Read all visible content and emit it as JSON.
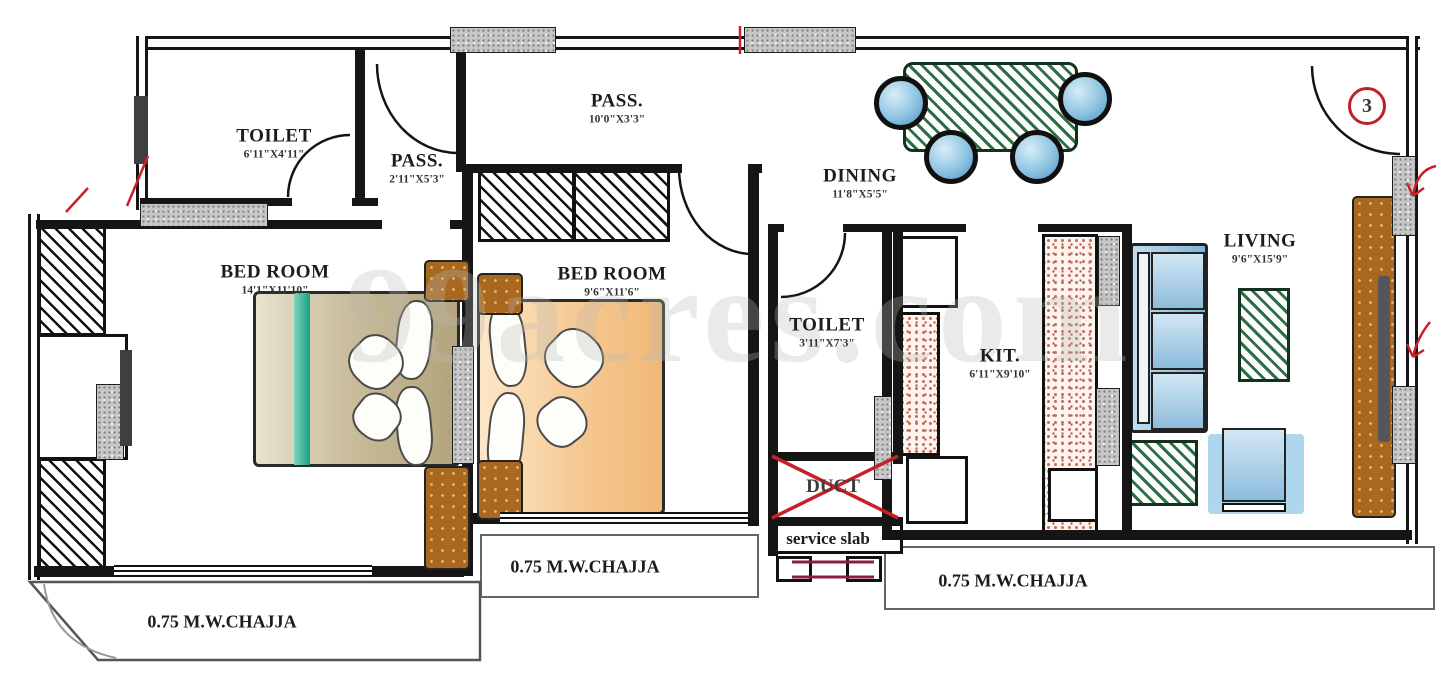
{
  "watermark": {
    "text": "99acres.com"
  },
  "unit": {
    "number": "3"
  },
  "rooms": [
    {
      "name": "TOILET",
      "dims": "6'11\"X4'11\""
    },
    {
      "name": "PASS.",
      "dims": "2'11\"X5'3\""
    },
    {
      "name": "PASS.",
      "dims": "10'0\"X3'3\""
    },
    {
      "name": "BED ROOM",
      "dims": "14'1\"X11'10\""
    },
    {
      "name": "BED ROOM",
      "dims": "9'6\"X11'6\""
    },
    {
      "name": "DINING",
      "dims": "11'8\"X5'5\""
    },
    {
      "name": "TOILET",
      "dims": "3'11\"X7'3\""
    },
    {
      "name": "KIT.",
      "dims": "6'11\"X9'10\""
    },
    {
      "name": "LIVING",
      "dims": "9'6\"X15'9\""
    }
  ],
  "annotations": {
    "duct": "DUCT",
    "service_slab": "service slab",
    "chajja_left": "0.75 M.W.CHAJJA",
    "chajja_mid": "0.75 M.W.CHAJJA",
    "chajja_right": "0.75 M.W.CHAJJA"
  },
  "colors": {
    "wall": "#151515",
    "accent_red": "#c0202a",
    "chair_blue": "#8ec4e2",
    "hatch_green": "#2d6e45",
    "counter_pink": "#c4705c",
    "wardrobe_brown": "#a8681f",
    "bed_tan": "#c9bd9c",
    "bed_peach": "#f6c892",
    "bed_teal": "#18a184",
    "maroon": "#8c1f3f"
  }
}
